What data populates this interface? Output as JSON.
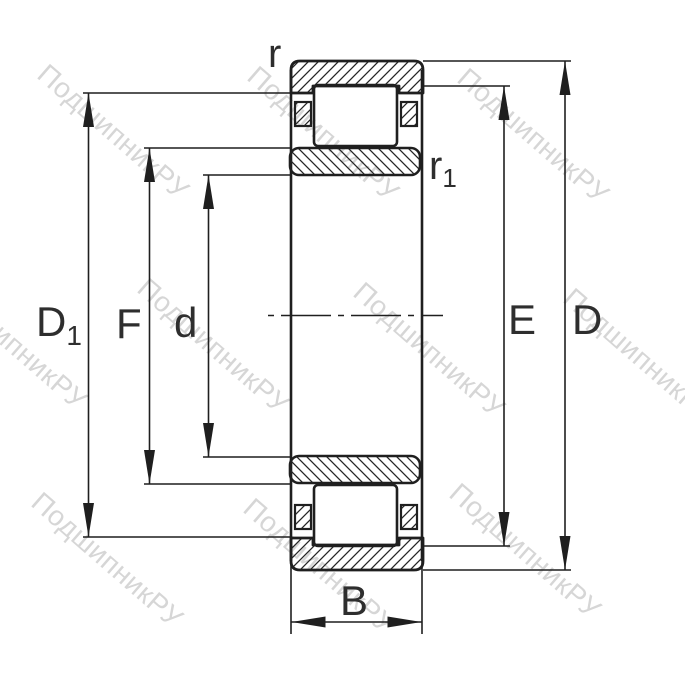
{
  "drawing": {
    "type": "bearing-cross-section",
    "part": "cylindrical-roller-bearing"
  },
  "labels": {
    "r": "r",
    "r1": {
      "main": "r",
      "sub": "1"
    },
    "D1": {
      "main": "D",
      "sub": "1"
    },
    "F": "F",
    "d": "d",
    "E": "E",
    "D": "D",
    "B": "B"
  },
  "watermark": {
    "text": "ПодшипникРУ",
    "color": "#d6d6d6"
  },
  "colors": {
    "line": "#1f1f1f",
    "label": "#2e2e2e",
    "background": "#ffffff"
  }
}
